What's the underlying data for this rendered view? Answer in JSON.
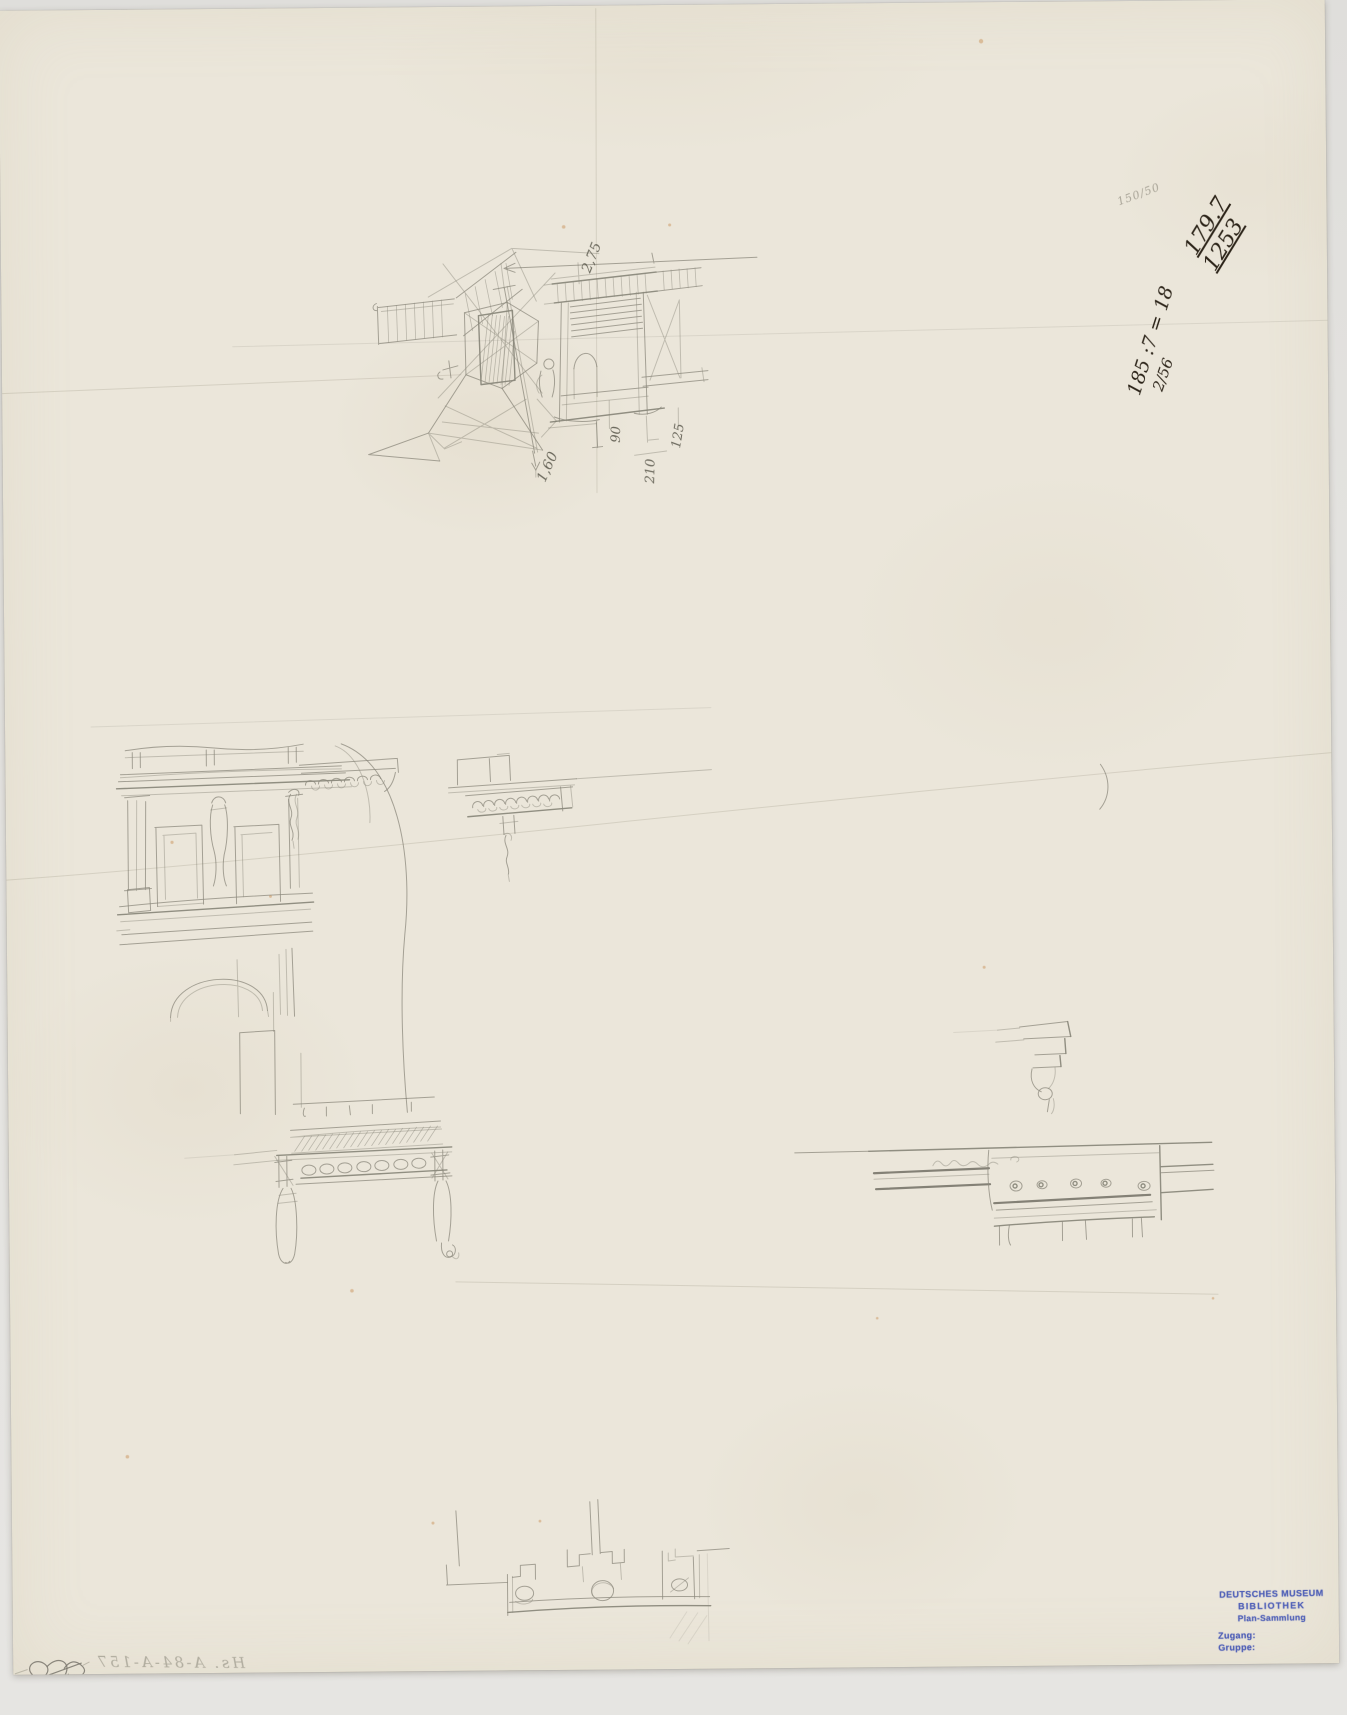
{
  "handwritten_ink": {
    "number_top": "179.7",
    "number_bottom": "1253",
    "calculation": "185 :7 = 18",
    "fraction": "2/56"
  },
  "handwritten_pencil": {
    "faint_note": "150/50",
    "verso_showthrough": "Hs. A-84-A-157",
    "dimension_labels": [
      "2,75",
      "1,60",
      "90",
      "210",
      "125"
    ]
  },
  "stamp": {
    "lines": [
      "DEUTSCHES MUSEUM",
      "BIBLIOTHEK",
      "Plan-Sammlung",
      "Zugang:",
      "Gruppe:"
    ],
    "ink_color": "#4053b4"
  },
  "palette": {
    "background": "#e4e3e0",
    "paper": "#ebe6da",
    "pencil": "#6c6a5e",
    "ink": "#2b2318"
  }
}
